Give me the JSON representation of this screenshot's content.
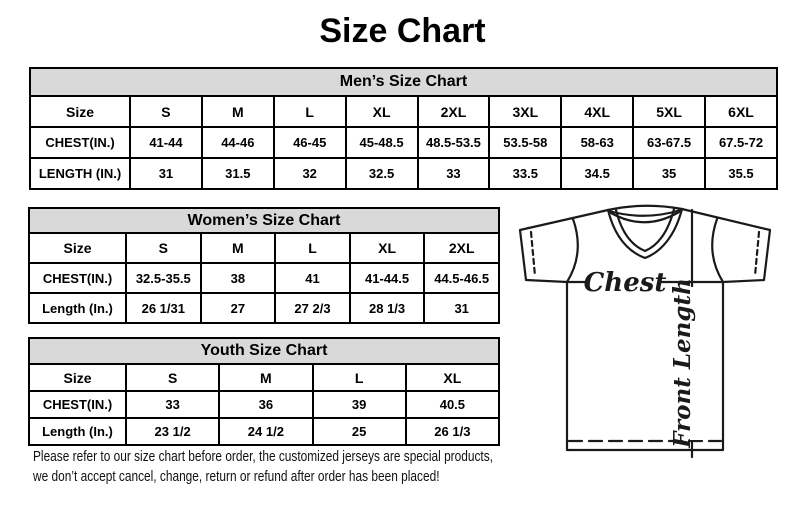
{
  "page": {
    "title": "Size Chart",
    "note_line1": "Please refer to our size chart before order, the customized jerseys are special products,",
    "note_line2": "we don’t accept cancel, change, return or refund after order has been placed!"
  },
  "tables": [
    {
      "id": "mens",
      "title": "Men’s Size Chart",
      "rows": [
        [
          "Size",
          "S",
          "M",
          "L",
          "XL",
          "2XL",
          "3XL",
          "4XL",
          "5XL",
          "6XL"
        ],
        [
          "CHEST(IN.)",
          "41-44",
          "44-46",
          "46-45",
          "45-48.5",
          "48.5-53.5",
          "53.5-58",
          "58-63",
          "63-67.5",
          "67.5-72"
        ],
        [
          "LENGTH (IN.)",
          "31",
          "31.5",
          "32",
          "32.5",
          "33",
          "33.5",
          "34.5",
          "35",
          "35.5"
        ]
      ]
    },
    {
      "id": "womens",
      "title": "Women’s Size Chart",
      "rows": [
        [
          "Size",
          "S",
          "M",
          "L",
          "XL",
          "2XL"
        ],
        [
          "CHEST(IN.)",
          "32.5-35.5",
          "38",
          "41",
          "41-44.5",
          "44.5-46.5"
        ],
        [
          "Length (In.)",
          "26 1/31",
          "27",
          "27 2/3",
          "28 1/3",
          "31"
        ]
      ]
    },
    {
      "id": "youth",
      "title": "Youth Size Chart",
      "rows": [
        [
          "Size",
          "S",
          "M",
          "L",
          "XL"
        ],
        [
          "CHEST(IN.)",
          "33",
          "36",
          "39",
          "40.5"
        ],
        [
          "Length (In.)",
          "23 1/2",
          "24 1/2",
          "25",
          "26 1/3"
        ]
      ]
    }
  ],
  "diagram": {
    "chest_label": "Chest",
    "front_length_label": "Front Length"
  },
  "colors": {
    "header_bg": "#d9d9d9",
    "border": "#000000",
    "text": "#000000",
    "line": "#1a1a1a"
  }
}
